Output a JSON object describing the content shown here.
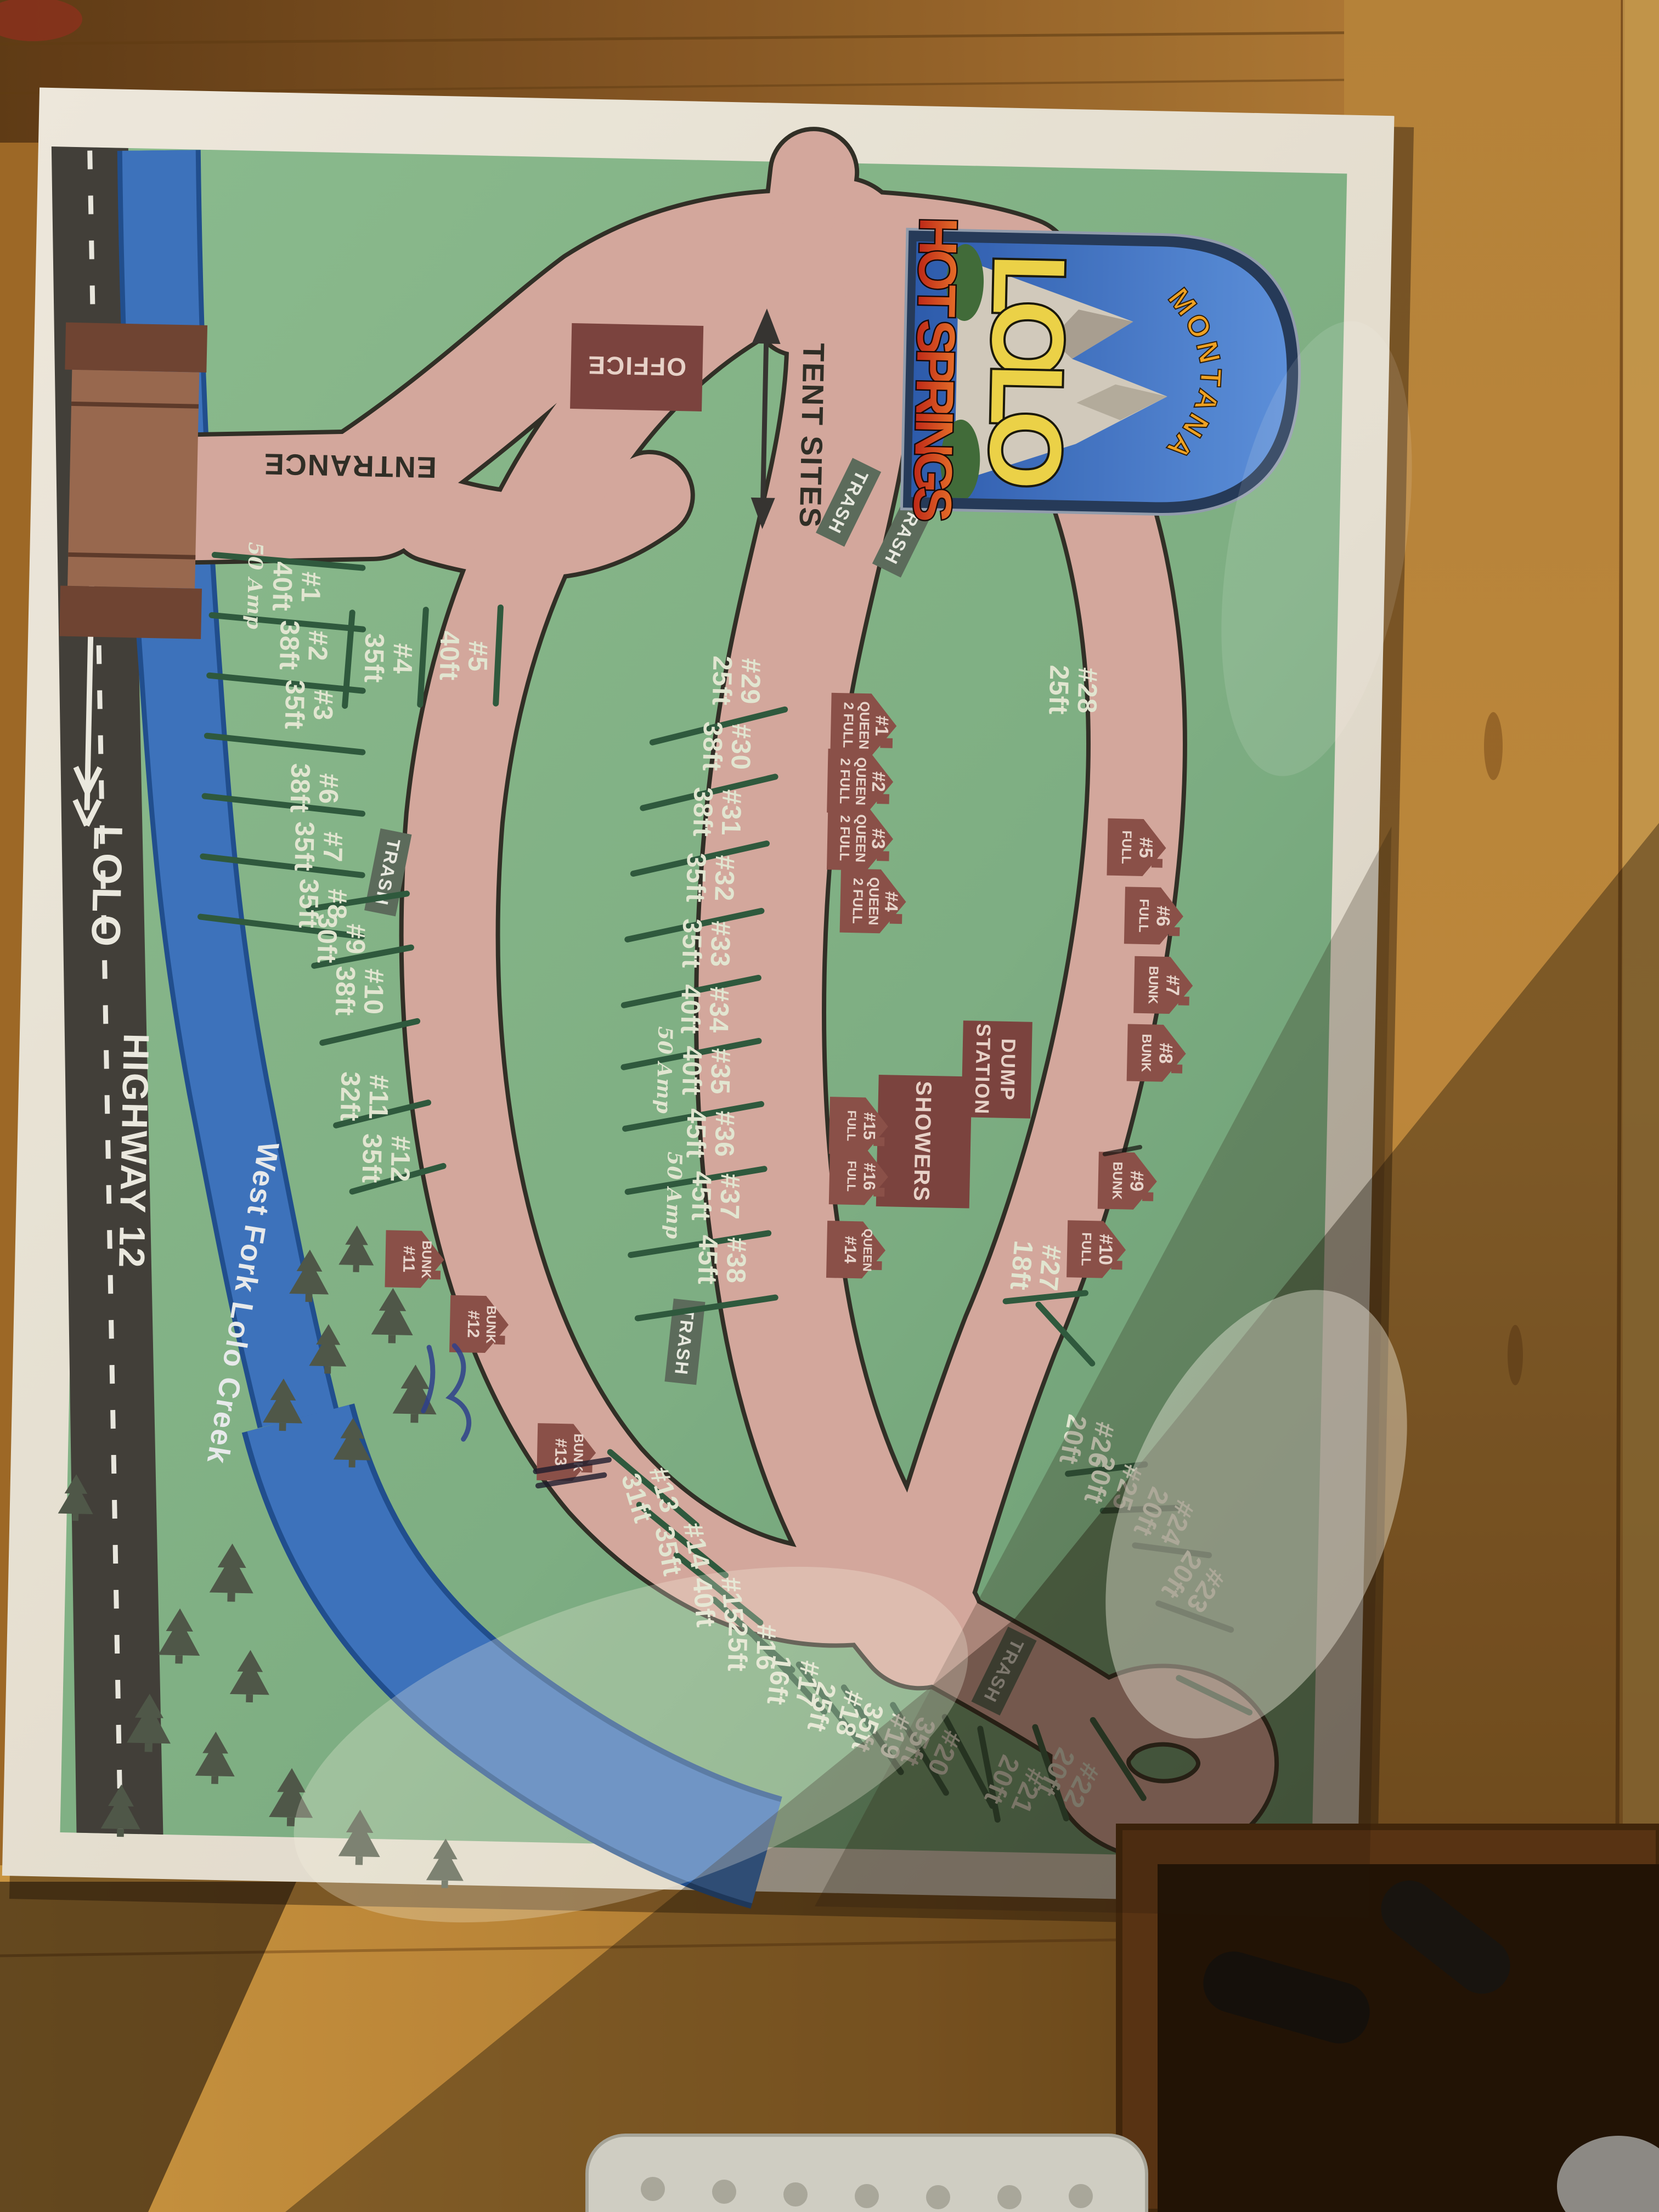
{
  "logo": {
    "state": "MONTANA",
    "name": "LOLO",
    "subtitle": "HOT SPRINGS"
  },
  "highway": {
    "route": "HIGHWAY 12",
    "direction": "LOLO"
  },
  "creek": {
    "name": "West Fork Lolo Creek"
  },
  "labels": {
    "entrance": "ENTRANCE",
    "office": "OFFICE",
    "tent_sites": "TENT SITES",
    "trash": "TRASH",
    "dump_line1": "DUMP",
    "dump_line2": "STATION",
    "showers": "SHOWERS"
  },
  "rv_sites": {
    "left_row": [
      {
        "id": "#1",
        "length": "40ft",
        "power": "50 Amp"
      },
      {
        "id": "#2",
        "length": "38ft"
      },
      {
        "id": "#3",
        "length": "35ft"
      },
      {
        "id": "#6",
        "length": "38ft"
      },
      {
        "id": "#7",
        "length": "35ft"
      },
      {
        "id": "#8",
        "length": "35ft"
      }
    ],
    "entry_side": [
      {
        "id": "#4",
        "length": "35ft"
      },
      {
        "id": "#5",
        "length": "40ft"
      }
    ],
    "west_fan": [
      {
        "id": "#9",
        "length": "30ft"
      },
      {
        "id": "#10",
        "length": "38ft"
      },
      {
        "id": "#11",
        "length": "32ft"
      },
      {
        "id": "#12",
        "length": "35ft"
      }
    ],
    "inner_row": [
      {
        "id": "#29",
        "length": "25ft"
      },
      {
        "id": "#30",
        "length": "38ft"
      },
      {
        "id": "#31",
        "length": "38ft"
      },
      {
        "id": "#32",
        "length": "35ft"
      },
      {
        "id": "#33",
        "length": "35ft"
      },
      {
        "id": "#34",
        "length": "40ft"
      },
      {
        "id": "#35",
        "length": "40ft",
        "power": "50 Amp"
      },
      {
        "id": "#36",
        "length": "45ft"
      },
      {
        "id": "#37",
        "length": "45ft",
        "power": "50 Amp"
      },
      {
        "id": "#38",
        "length": "45ft"
      }
    ],
    "south_fan": [
      {
        "id": "#13",
        "length": "31ft"
      },
      {
        "id": "#14",
        "length": "35ft"
      },
      {
        "id": "#15",
        "length": "40ft"
      },
      {
        "id": "#16",
        "length": "25ft"
      },
      {
        "id": "#17",
        "length": "16ft"
      },
      {
        "id": "#18",
        "length": "25ft"
      },
      {
        "id": "#19",
        "length": "35ft"
      },
      {
        "id": "#20",
        "length": "35ft"
      }
    ],
    "east_fan": [
      {
        "id": "#21",
        "length": "20ft"
      },
      {
        "id": "#22",
        "length": "20ft"
      },
      {
        "id": "#23",
        "length": "20ft"
      },
      {
        "id": "#24",
        "length": "20ft"
      },
      {
        "id": "#25",
        "length": "20ft"
      },
      {
        "id": "#26",
        "length": "20ft"
      },
      {
        "id": "#27",
        "length": "18ft"
      },
      {
        "id": "#28",
        "length": "25ft"
      }
    ]
  },
  "cabins": {
    "queen_row": [
      {
        "id": "#1",
        "bed1": "QUEEN",
        "bed2": "2 FULL"
      },
      {
        "id": "#2",
        "bed1": "QUEEN",
        "bed2": "2 FULL"
      },
      {
        "id": "#3",
        "bed1": "QUEEN",
        "bed2": "2 FULL"
      },
      {
        "id": "#4",
        "bed1": "QUEEN",
        "bed2": "2 FULL"
      }
    ],
    "east_row": [
      {
        "id": "#5",
        "type": "FULL"
      },
      {
        "id": "#6",
        "type": "FULL"
      },
      {
        "id": "#7",
        "type": "BUNK"
      },
      {
        "id": "#8",
        "type": "BUNK"
      },
      {
        "id": "#9",
        "type": "BUNK"
      },
      {
        "id": "#10",
        "type": "FULL"
      }
    ],
    "south_row": [
      {
        "type": "BUNK",
        "id": "#11"
      },
      {
        "type": "BUNK",
        "id": "#12"
      },
      {
        "type": "BUNK",
        "id": "#13"
      }
    ],
    "center_row": [
      {
        "line1": "#15",
        "line2": "FULL"
      },
      {
        "line1": "#16",
        "line2": "FULL"
      },
      {
        "line1": "QUEEN",
        "line2": "#14"
      }
    ]
  }
}
